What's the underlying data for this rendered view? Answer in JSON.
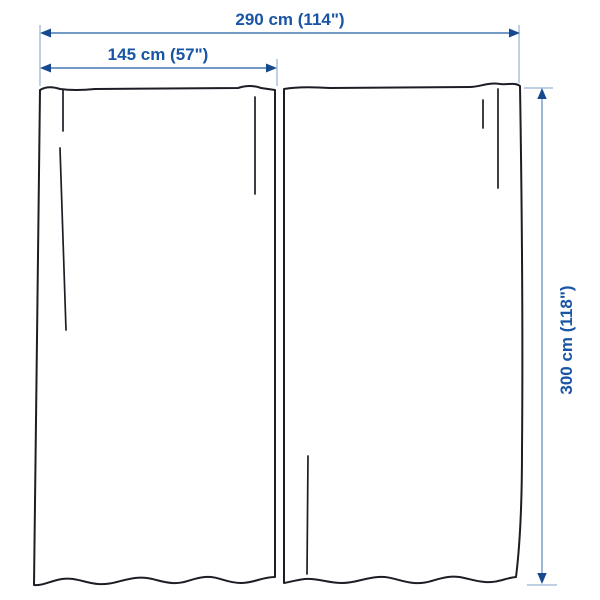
{
  "diagram_title": "curtain pair dimension diagram",
  "labels": {
    "total_width": "290 cm (114\")",
    "panel_width": "145 cm (57\")",
    "height": "300 cm (118\")"
  },
  "measurements": {
    "total_width": {
      "cm": 290,
      "inches": 114
    },
    "panel_width": {
      "cm": 145,
      "inches": 57
    },
    "height": {
      "cm": 300,
      "inches": 118
    }
  },
  "colors": {
    "bg": "#ffffff",
    "outline": "#1d1d25",
    "text": "#1a55a5",
    "dim_line": "#5f8cbf",
    "dim_line_light": "#93b1d4",
    "ext_line": "#a9c1dc",
    "arrow": "#17498f"
  }
}
